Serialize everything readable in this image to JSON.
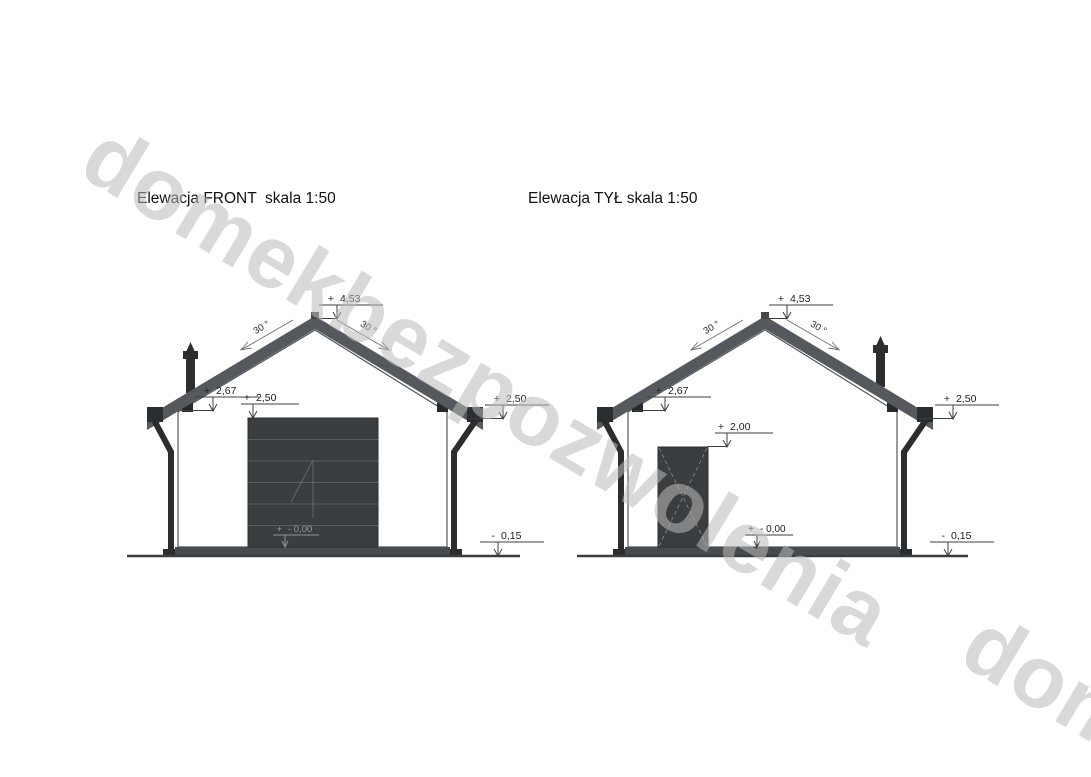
{
  "watermark": {
    "text": "domekbezpozwolenia",
    "fragment_text": "dom",
    "color": "#bababa"
  },
  "colors": {
    "roof": "#55585c",
    "metal": "#2b2e30",
    "door": "#3b3e40",
    "plinth": "#484b4e",
    "line": "#3c3f41"
  },
  "elevations": [
    {
      "title": "Elewacja FRONT  skala 1:50",
      "scale": "1:50",
      "slope_left": "30 °",
      "slope_right": "30 °",
      "opening_type": "garage-door",
      "markers": {
        "ridge_sign": "+",
        "ridge_value": "4,53",
        "eave_sign": "+",
        "eave_value": "2,67",
        "opening_sign": "+",
        "opening_value": "2,50",
        "gutter_sign": "+",
        "gutter_value": "2,50",
        "floor_sign": "+",
        "floor_value": "- 0,00",
        "ground_sign": "-",
        "ground_value": "0,15"
      }
    },
    {
      "title": "Elewacja TYŁ skala 1:50",
      "scale": "1:50",
      "slope_left": "30 °",
      "slope_right": "30 °",
      "opening_type": "door",
      "markers": {
        "ridge_sign": "+",
        "ridge_value": "4,53",
        "eave_sign": "+",
        "eave_value": "2,67",
        "opening_sign": "+",
        "opening_value": "2,00",
        "gutter_sign": "+",
        "gutter_value": "2,50",
        "floor_sign": "+",
        "floor_value": "- 0,00",
        "ground_sign": "-",
        "ground_value": "0,15"
      }
    }
  ]
}
